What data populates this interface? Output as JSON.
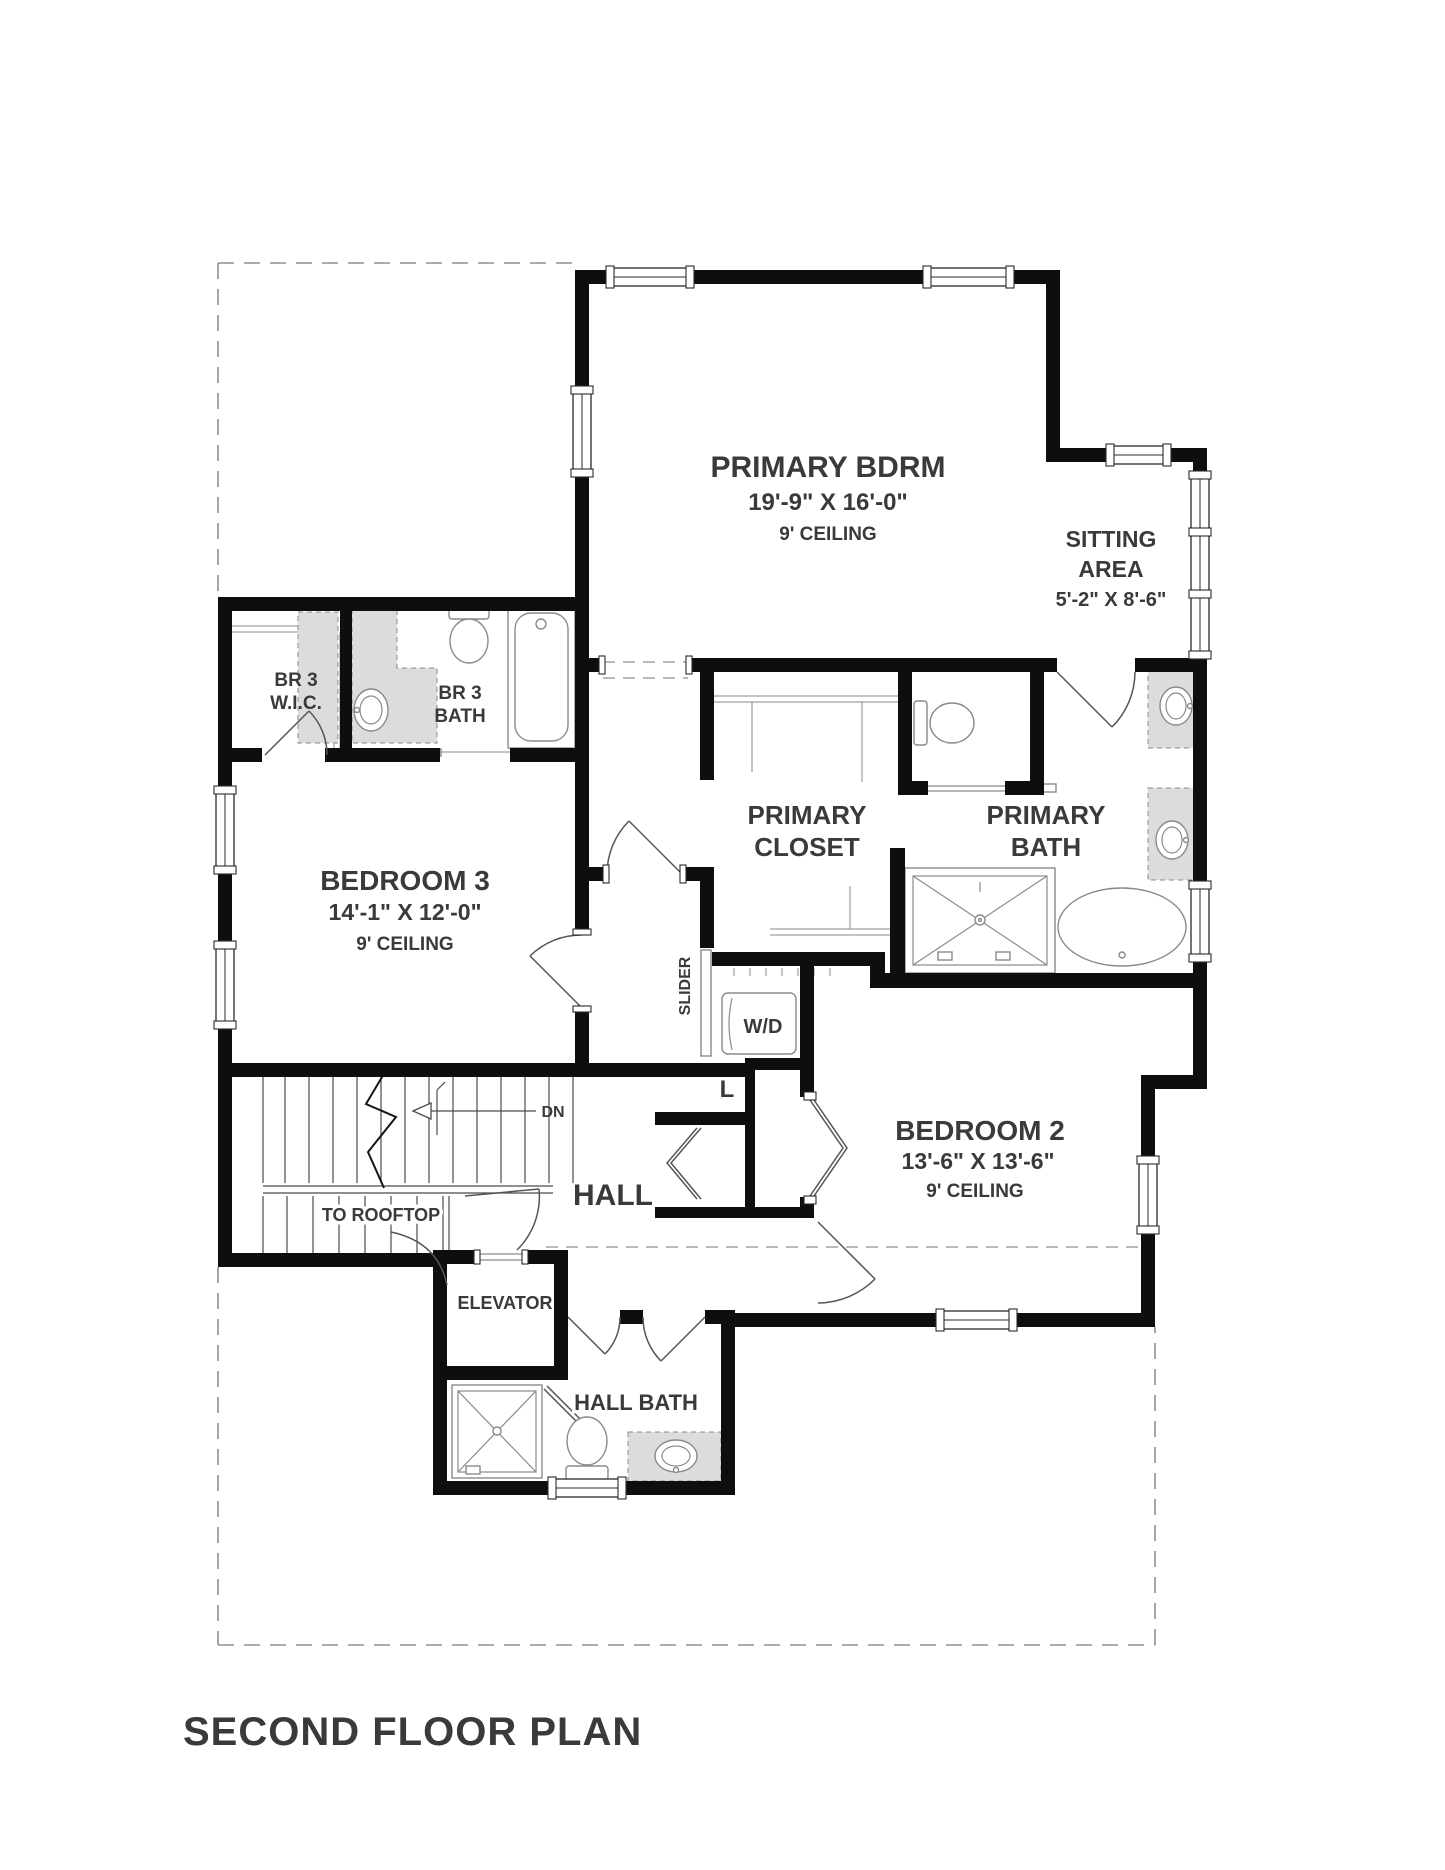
{
  "title": "SECOND FLOOR PLAN",
  "colors": {
    "wall": "#0e0e0e",
    "text": "#3a3a3a",
    "fixture": "#8a8a8a",
    "stair": "#4a4a4a",
    "door": "#555555",
    "dashed": "#8f8f8f",
    "vanity": "#dcdcdc",
    "line_dark": "#2a2a2a"
  },
  "rooms": {
    "primary_bdrm": {
      "name": "PRIMARY BDRM",
      "dims": "19'-9\" X 16'-0\"",
      "ceiling": "9' CEILING"
    },
    "sitting_area": {
      "line1": "SITTING",
      "line2": "AREA",
      "dims": "5'-2\" X 8'-6\""
    },
    "br3_wic": {
      "line1": "BR 3",
      "line2": "W.I.C."
    },
    "br3_bath": {
      "line1": "BR 3",
      "line2": "BATH"
    },
    "bedroom3": {
      "name": "BEDROOM 3",
      "dims": "14'-1\" X 12'-0\"",
      "ceiling": "9' CEILING"
    },
    "primary_closet": {
      "line1": "PRIMARY",
      "line2": "CLOSET"
    },
    "primary_bath": {
      "line1": "PRIMARY",
      "line2": "BATH"
    },
    "bedroom2": {
      "name": "BEDROOM 2",
      "dims": "13'-6\" X 13'-6\"",
      "ceiling": "9' CEILING"
    },
    "hall": {
      "name": "HALL"
    },
    "elevator": {
      "name": "ELEVATOR"
    },
    "hall_bath": {
      "name": "HALL BATH"
    },
    "laundry": {
      "name": "W/D"
    },
    "linen": {
      "name": "L"
    }
  },
  "annotations": {
    "slider": "SLIDER",
    "down": "DN",
    "to_rooftop": "TO ROOFTOP"
  }
}
